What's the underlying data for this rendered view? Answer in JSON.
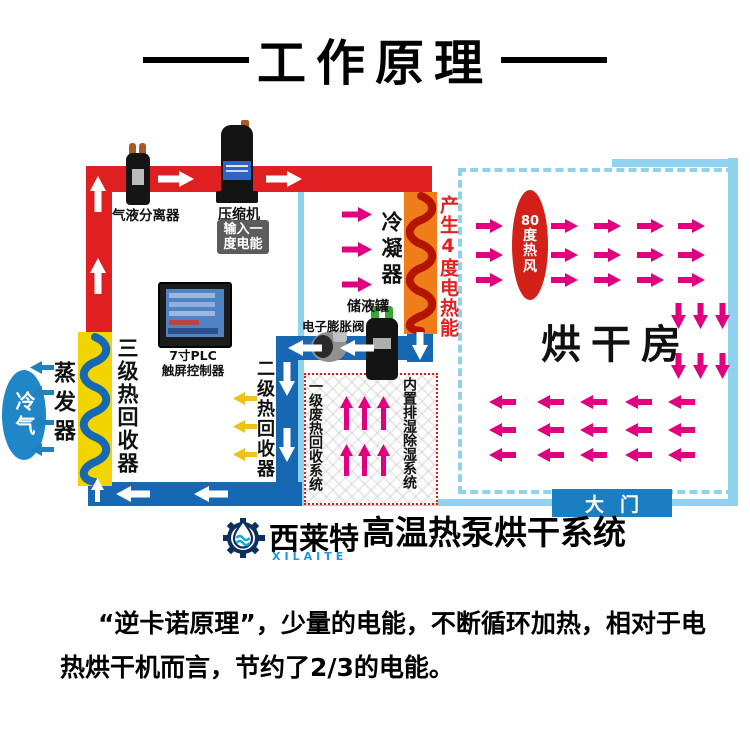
{
  "title": "工作原理",
  "diagram": {
    "separator_label": "气液分离器",
    "compressor_label": "压缩机",
    "compressor_badge": {
      "line1": "输入一",
      "line2": "度电能"
    },
    "condenser_label": "冷凝器",
    "heat_output_label": "产生4度电热能",
    "hot_wind": {
      "l1": "80",
      "l2": "度",
      "l3": "热",
      "l4": "风"
    },
    "drying_room_label": "烘干房",
    "door_label": "大门",
    "plc": {
      "line1": "7寸PLC",
      "line2": "触屏控制器"
    },
    "tank_label": "储液罐",
    "valve_label": "电子膨胀阀",
    "stage3_recovery_label": "三级热回收器",
    "evaporator_label": "蒸发器",
    "cold_air_label": "冷气",
    "stage2_recovery_label": "二级热回收器",
    "stage1_recovery_label": "一级废热回收系统",
    "dehumidifier_label": "内置排湿除湿系统"
  },
  "branding": {
    "name_cn": "西莱特",
    "name_en": "XILAITE",
    "product": "高温热泵烘干系统"
  },
  "description": {
    "line1": "“逆卡诺原理”，少量的电能，不断循环加热，相对于电",
    "line2": "热烘干机而言，节约了2/3的电能。"
  },
  "colors": {
    "hot_pipe": "#e02020",
    "cold_pipe": "#1668b3",
    "room_border": "#8fd2ee",
    "hot_air_arrow": "#e0007f",
    "condenser_body": "#ef7d1a",
    "condenser_coil": "#b51500",
    "recovery_block": "#f2d400",
    "recovery_coil": "#1668b3",
    "hot_wind_oval": "#d32018",
    "cold_air_oval": "#1f86c8",
    "door": "#1b7ec2",
    "warn_box_border": "#d42010",
    "stage2_arrow": "#eec11e",
    "evaporator_arrow": "#2080c0"
  }
}
